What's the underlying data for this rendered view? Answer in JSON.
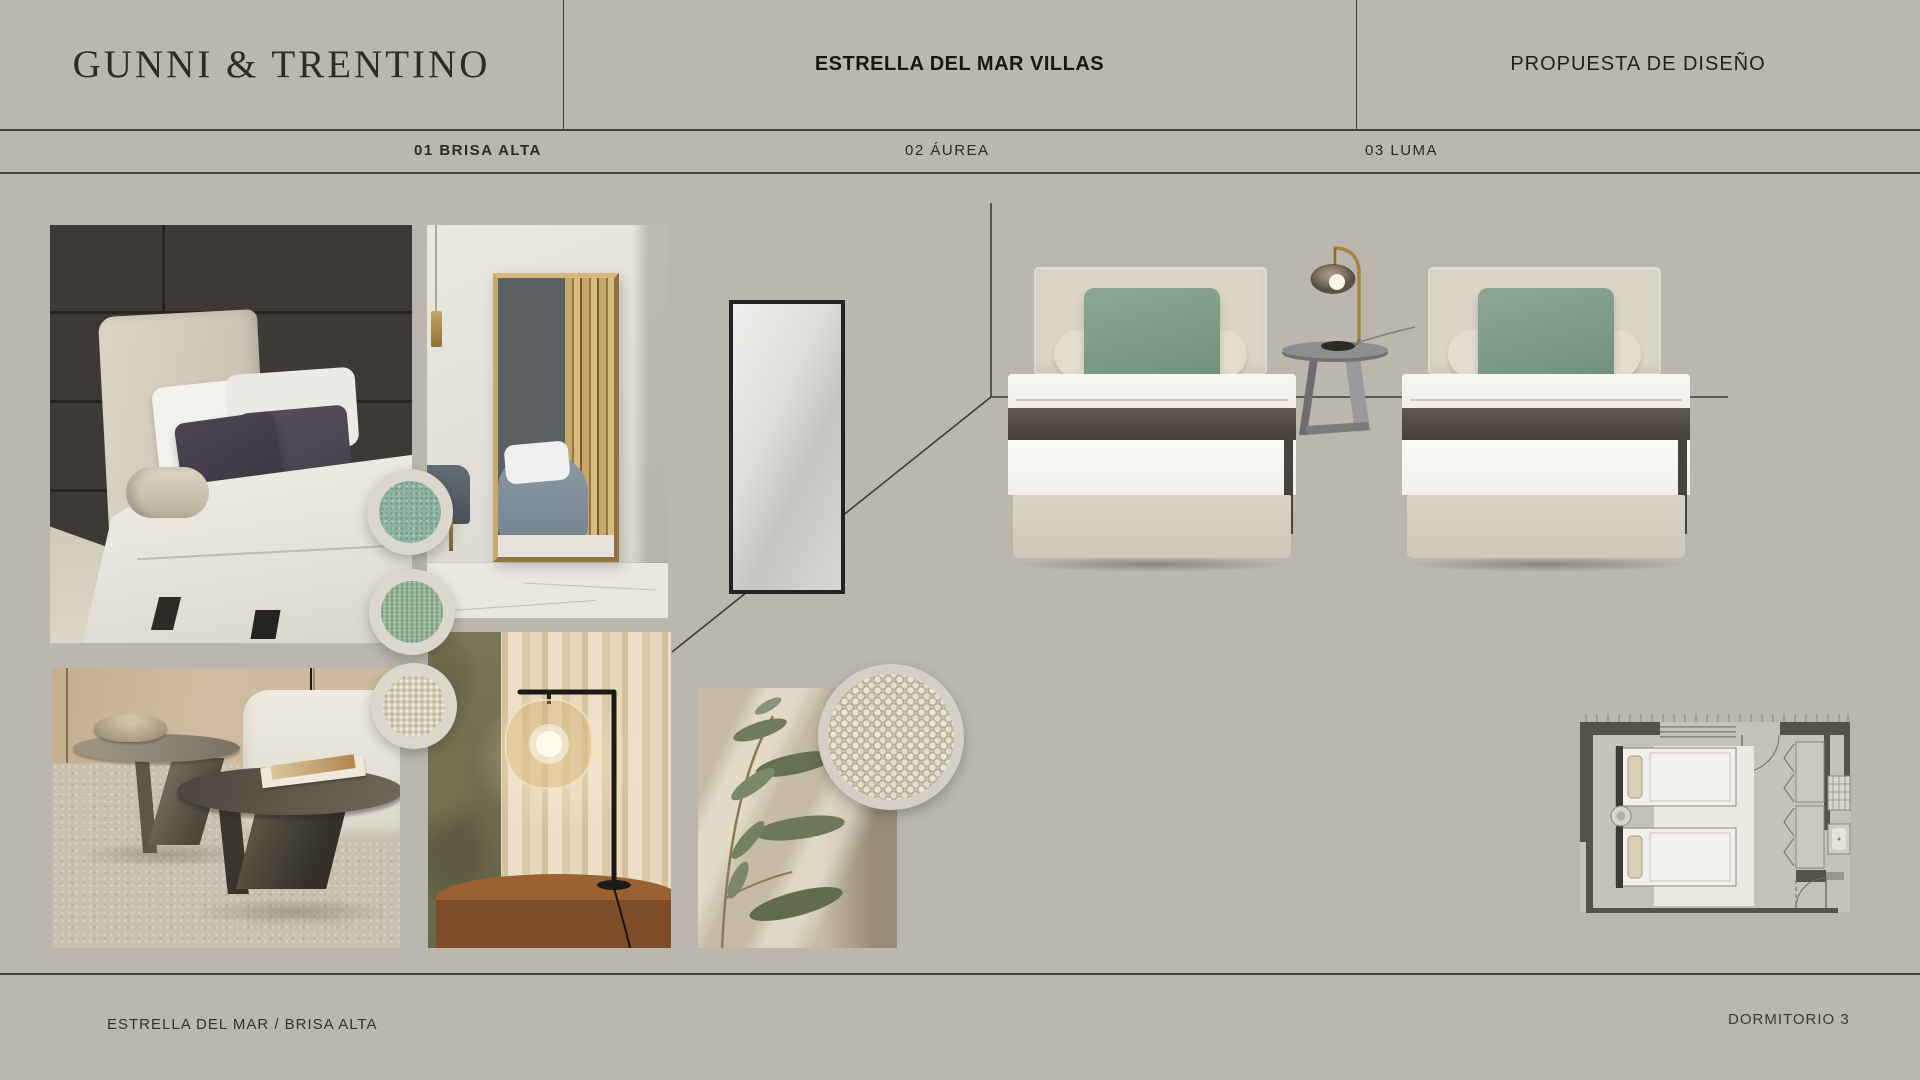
{
  "header": {
    "brand": "GUNNI & TRENTINO",
    "project": "ESTRELLA DEL MAR VILLAS",
    "proposal": "PROPUESTA DE DISEÑO"
  },
  "tabs": [
    {
      "label": "01 BRISA ALTA",
      "active": true
    },
    {
      "label": "02 ÁUREA",
      "active": false
    },
    {
      "label": "03 LUMA",
      "active": false
    }
  ],
  "footer": {
    "left": "ESTRELLA DEL MAR / BRISA ALTA",
    "right": "DORMITORIO 3"
  },
  "colors": {
    "page_bg": "#bcb7ae",
    "rule_lines": "#45423c",
    "text_dark": "#2c2a26",
    "sage_pillow": "#7f9e89",
    "teal_swatch": "#8fb3a2",
    "sage_swatch": "#94b49a",
    "cream_swatch": "#d7d1bc",
    "boucle_swatch": "#cfc9b2",
    "gold_mirror_frame": "#c9a868",
    "brass_lamp": "#a8823f",
    "bed_upholstery": "#dbd5c8",
    "plan_walls": "#55514b"
  }
}
